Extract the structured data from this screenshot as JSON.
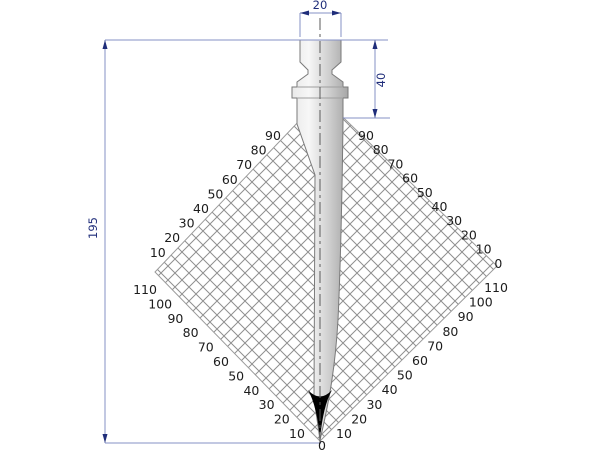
{
  "diagram": {
    "type": "press-brake-punch-technical-drawing",
    "dimensions": {
      "top_width": "20",
      "head_height": "40",
      "total_height": "195"
    },
    "angle_scale": {
      "upper_left": [
        "90",
        "80",
        "70",
        "60",
        "50",
        "40",
        "30",
        "20",
        "10"
      ],
      "lower_left": [
        "110",
        "100",
        "90",
        "80",
        "70",
        "60",
        "50",
        "40",
        "30",
        "20",
        "10"
      ],
      "upper_right": [
        "90",
        "80",
        "70",
        "60",
        "50",
        "40",
        "30",
        "20",
        "10",
        "0"
      ],
      "lower_right": [
        "110",
        "100",
        "90",
        "80",
        "70",
        "60",
        "50",
        "40",
        "30",
        "20",
        "10"
      ],
      "bottom": "0"
    },
    "colors": {
      "dimension_line": "#8590c6",
      "dimension_text": "#1f2d7a",
      "hatch_line": "#8f8f8f",
      "outline": "#7a7a7a",
      "tip_fill": "#000000"
    }
  }
}
